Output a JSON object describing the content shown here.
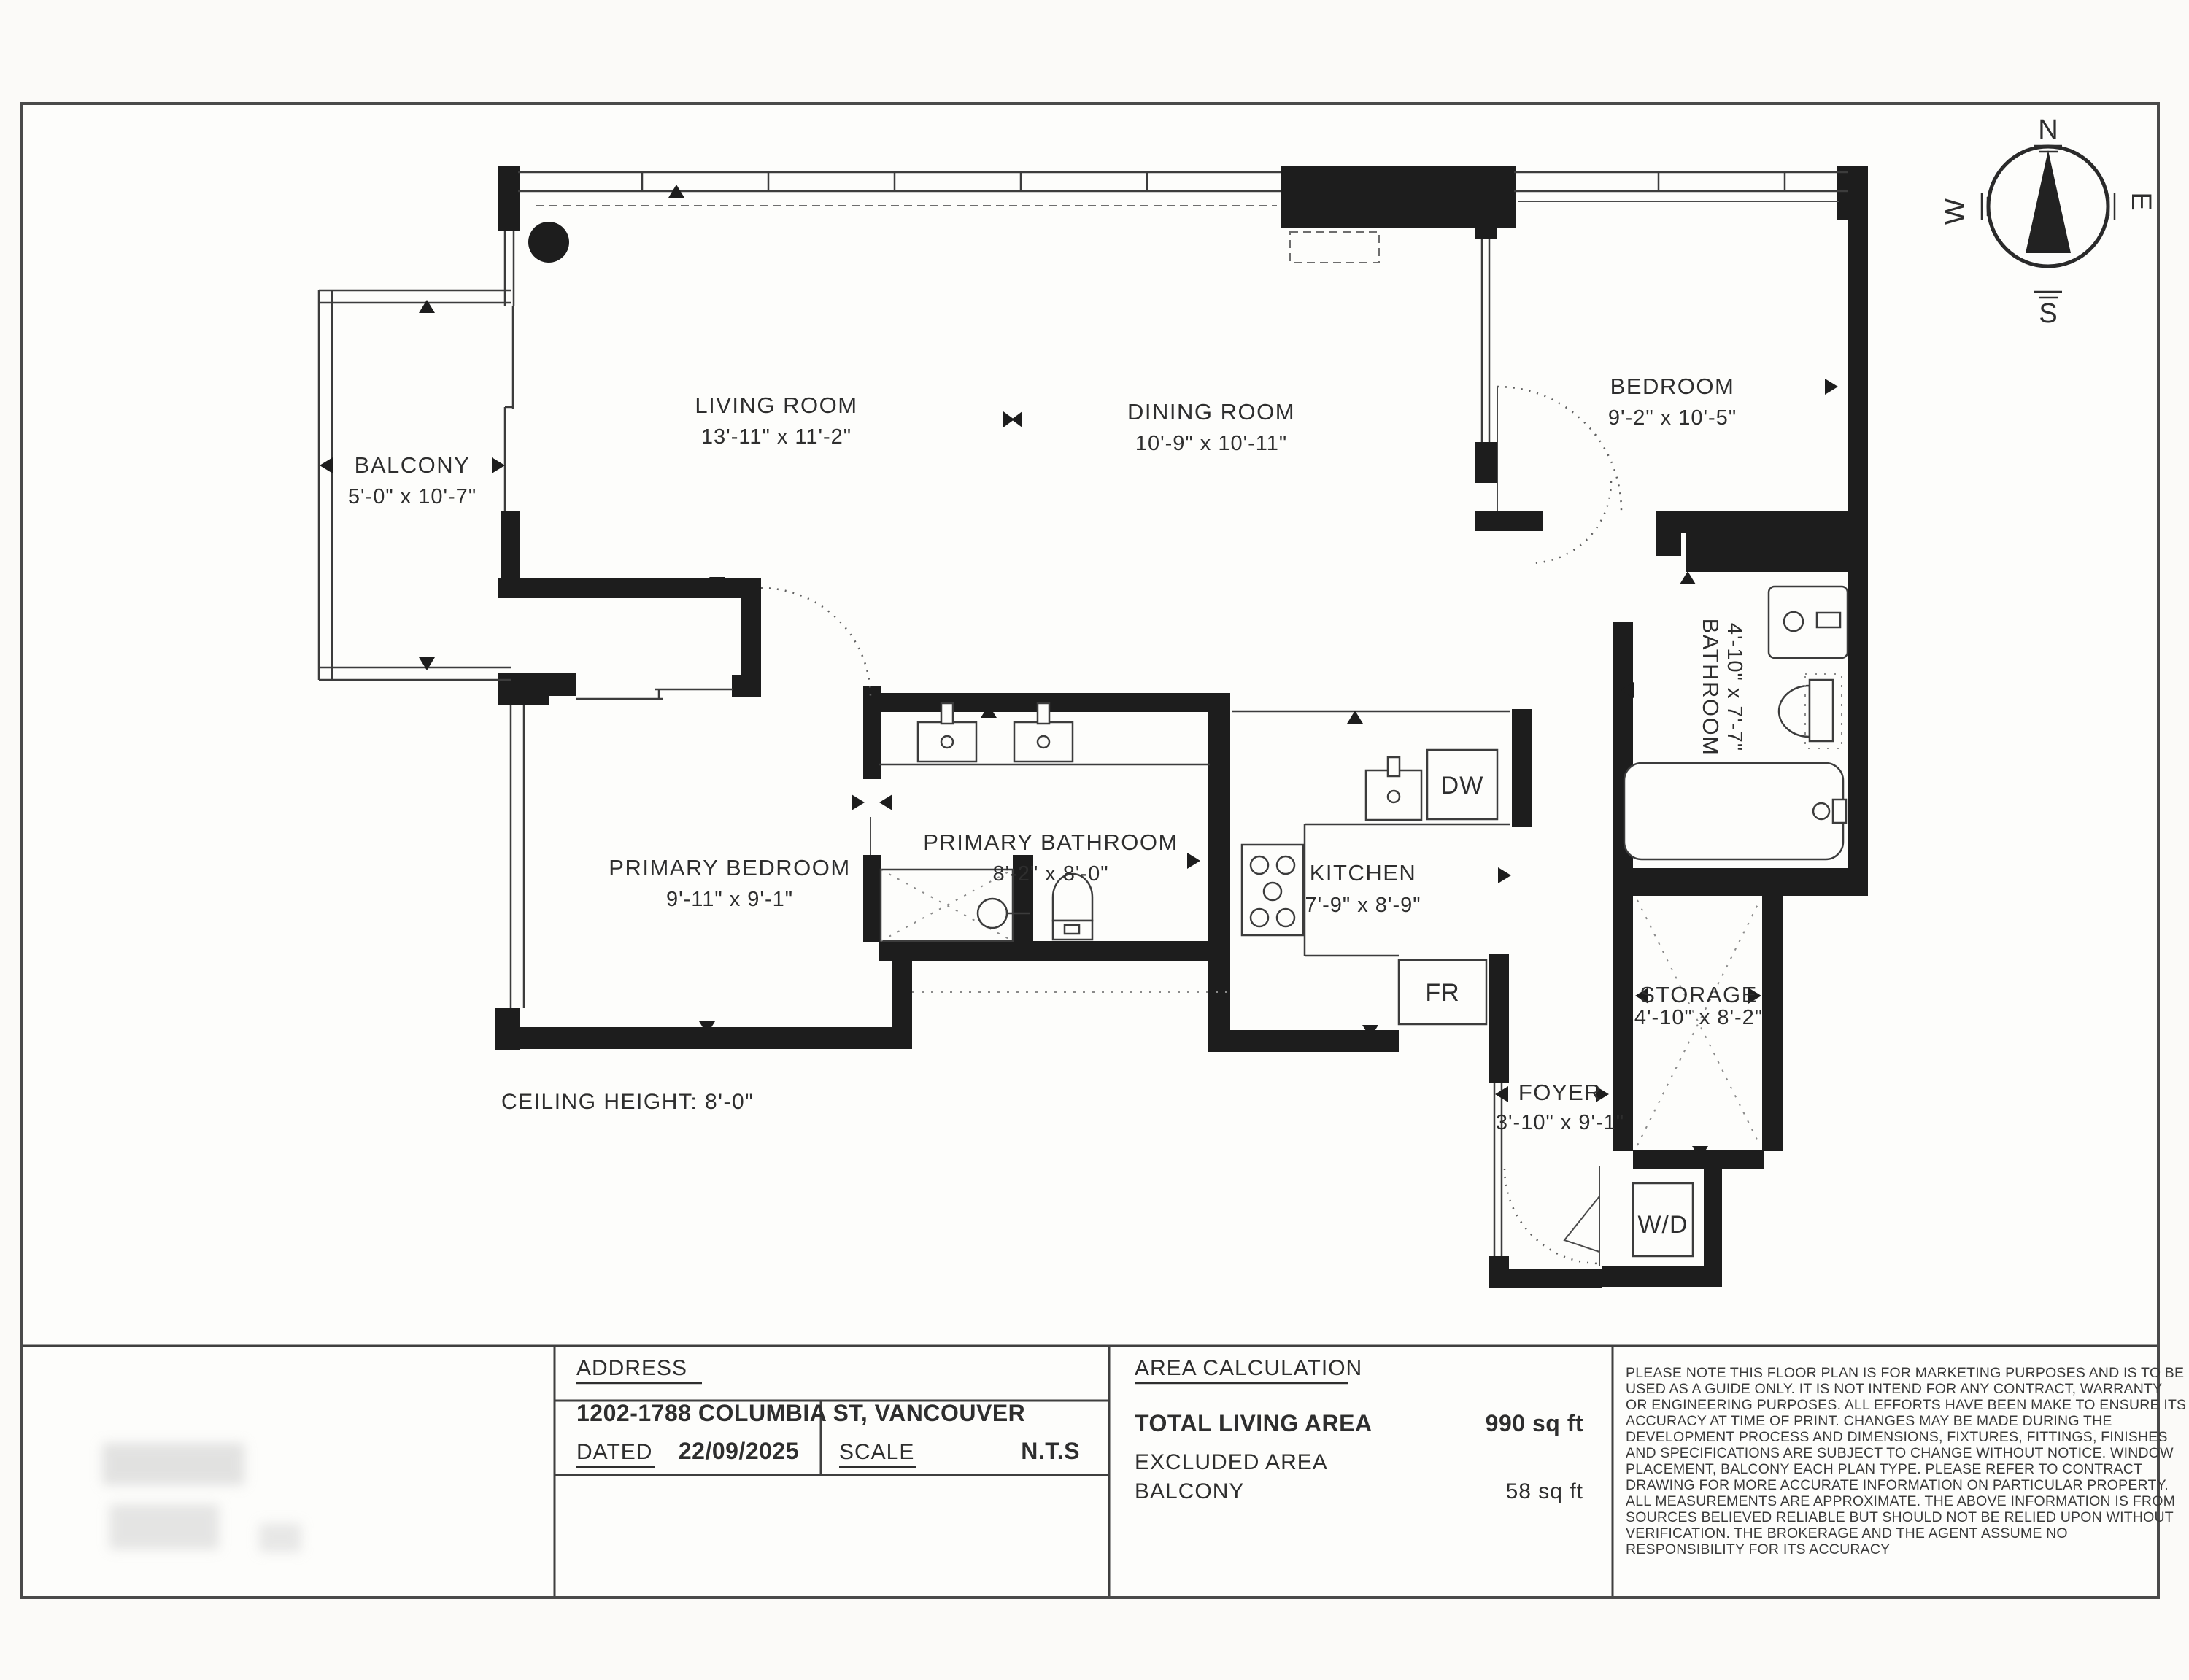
{
  "sheet": {
    "ceiling_note": "CEILING HEIGHT: 8'-0\"",
    "ink_color": "#1d1d1d",
    "paper_color": "#fdfdfb"
  },
  "compass": {
    "n": "N",
    "e": "E",
    "s": "S",
    "w": "W"
  },
  "rooms": {
    "balcony": {
      "name": "BALCONY",
      "dims": "5'-0\" x 10'-7\""
    },
    "living": {
      "name": "LIVING ROOM",
      "dims": "13'-11\" x 11'-2\""
    },
    "dining": {
      "name": "DINING ROOM",
      "dims": "10'-9\" x 10'-11\""
    },
    "bedroom": {
      "name": "BEDROOM",
      "dims": "9'-2\" x 10'-5\""
    },
    "bathroom": {
      "name": "BATHROOM",
      "dims": "4'-10\" x 7'-7\""
    },
    "primary_bedroom": {
      "name": "PRIMARY BEDROOM",
      "dims": "9'-11\" x 9'-1\""
    },
    "primary_bathroom": {
      "name": "PRIMARY BATHROOM",
      "dims": "8'-2\" x 8'-0\""
    },
    "kitchen": {
      "name": "KITCHEN",
      "dims": "7'-9\" x 8'-9\""
    },
    "storage": {
      "name": "STORAGE",
      "dims": "4'-10\" x 8'-2\""
    },
    "foyer": {
      "name": "FOYER",
      "dims": "3'-10\" x 9'-1\""
    }
  },
  "appliances": {
    "dishwasher": "DW",
    "fridge": "FR",
    "washer_dryer": "W/D"
  },
  "title_block": {
    "address_label": "ADDRESS",
    "address_value": "1202-1788 COLUMBIA ST, VANCOUVER",
    "dated_label": "DATED",
    "dated_value": "22/09/2025",
    "scale_label": "SCALE",
    "scale_value": "N.T.S",
    "area_heading": "AREA CALCULATION",
    "total_label": "TOTAL LIVING AREA",
    "total_value": "990 sq ft",
    "excluded_label": "EXCLUDED AREA",
    "excluded_item": "BALCONY",
    "excluded_value": "58 sq ft",
    "disclaimer_lines": [
      "PLEASE NOTE THIS FLOOR PLAN IS FOR MARKETING PURPOSES AND IS TO BE",
      "USED AS A GUIDE ONLY. IT IS NOT INTEND FOR ANY CONTRACT, WARRANTY",
      "OR ENGINEERING PURPOSES. ALL EFFORTS HAVE BEEN MAKE TO ENSURE ITS",
      "ACCURACY AT TIME OF PRINT. CHANGES MAY BE MADE DURING THE",
      "DEVELOPMENT PROCESS AND DIMENSIONS, FIXTURES, FITTINGS, FINISHES",
      "AND SPECIFICATIONS ARE SUBJECT TO CHANGE WITHOUT NOTICE. WINDOW",
      "PLACEMENT, BALCONY EACH PLAN TYPE. PLEASE REFER TO CONTRACT",
      "DRAWING FOR MORE ACCURATE INFORMATION ON PARTICULAR PROPERTY.",
      "ALL MEASUREMENTS ARE APPROXIMATE. THE ABOVE INFORMATION IS FROM",
      "SOURCES BELIEVED RELIABLE BUT SHOULD NOT BE RELIED UPON WITHOUT",
      "VERIFICATION. THE BROKERAGE AND THE AGENT ASSUME NO",
      "RESPONSIBILITY FOR ITS ACCURACY"
    ]
  }
}
